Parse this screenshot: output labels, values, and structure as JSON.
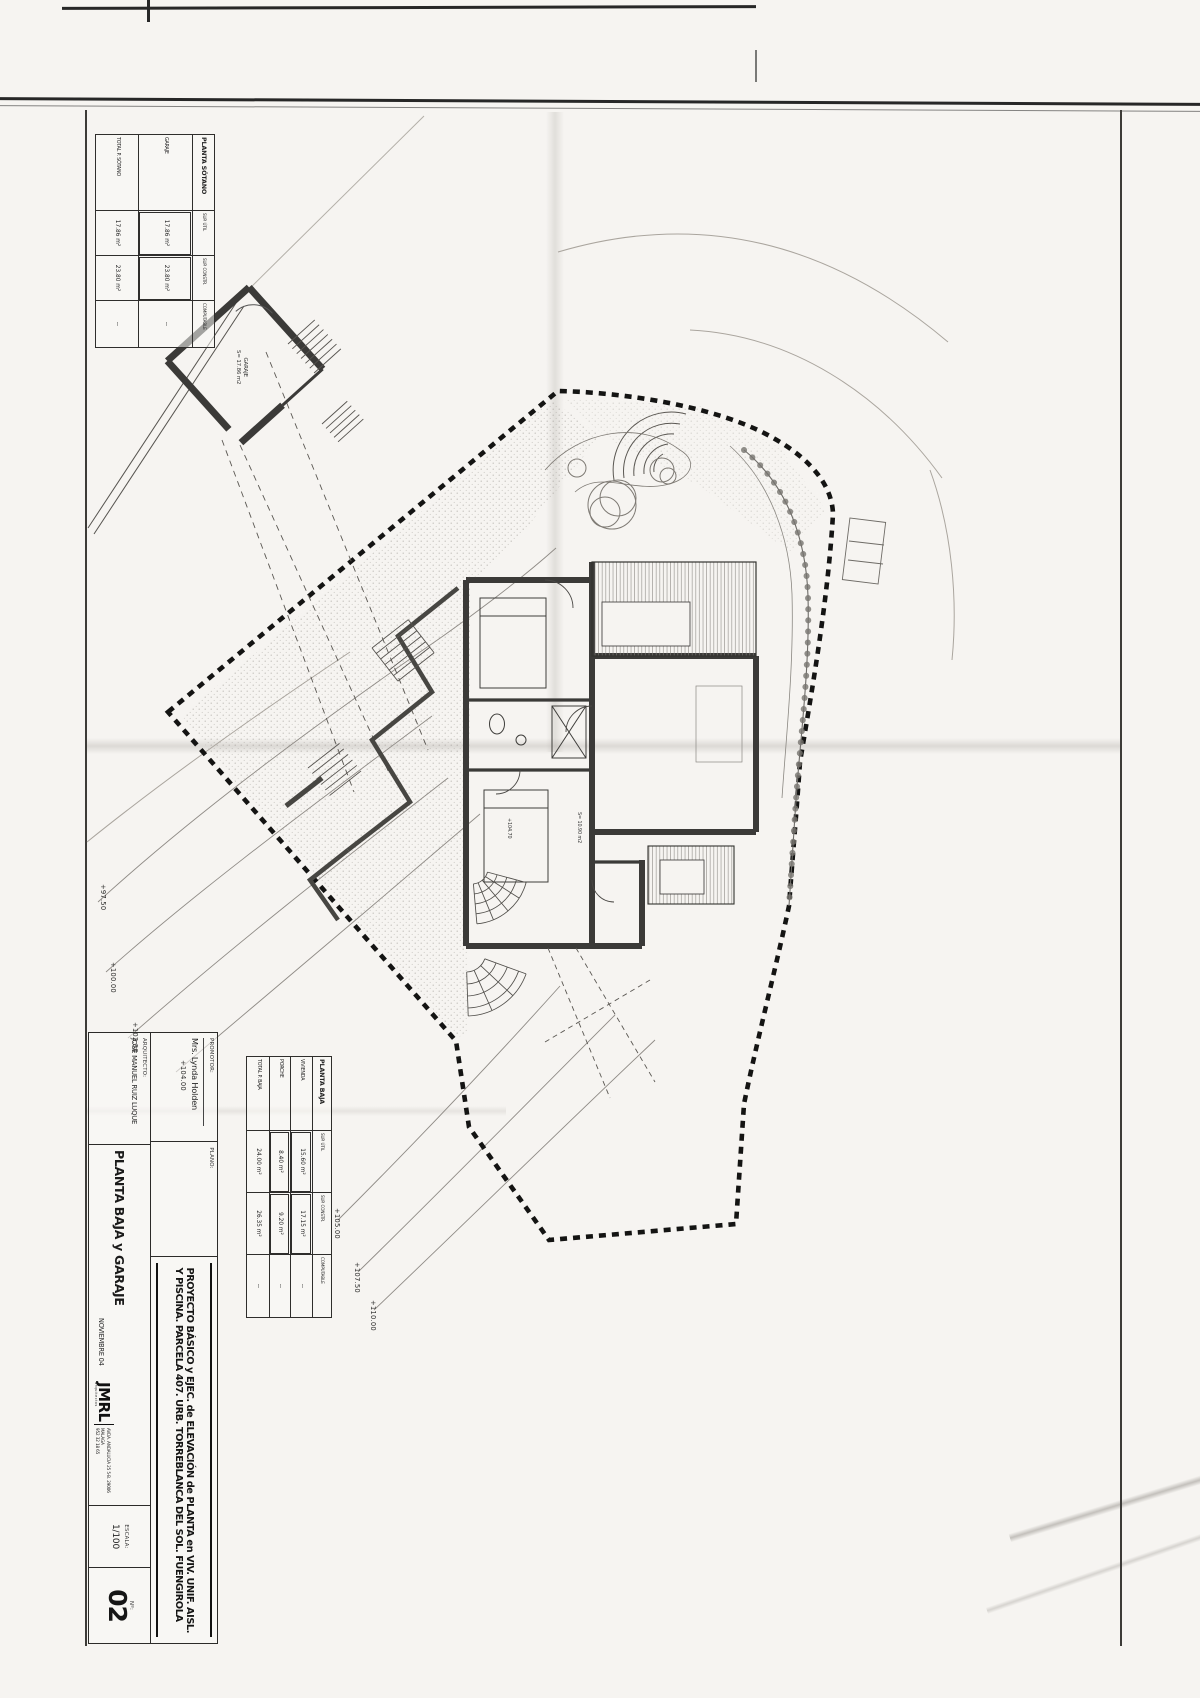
{
  "sheet": {
    "promotor_label": "PROMOTOR:",
    "promotor_name": "Mrs. Lynda Holden",
    "plano_label": "PLANO:",
    "plano_name": "PLANTA BAJA y GARAJE",
    "arquitecto_label": "ARQUITECTO:",
    "arquitecto_name": "JOSE MANUEL RUIZ LUQUE",
    "project_title_line1": "PROYECTO BÁSICO y EJEC. de ELEVACIÓN de PLANTA en VIV. UNIF. AISL.",
    "project_title_line2": "Y PISCINA. PARCELA 407. URB. TORREBLANCA DEL SOL. FUENGIROLA",
    "date": "NOVIEMBRE 04",
    "logo_text": "JMRL",
    "logo_subtext": "arquitectos",
    "logo_address": "AVDA. ANDALUCIA 25 5-B. 29006 MALAGA",
    "logo_phone": "952 32 18 65",
    "scale_label": "ESCALA:",
    "scale_value": "1/100",
    "sheet_no_label": "Nº:",
    "sheet_no_value": "02"
  },
  "area_tables": {
    "planta_sotano": {
      "title": "PLANTA SÓTANO",
      "columns": [
        "SUP. ÚTIL",
        "SUP. CONSTR.",
        "COMPUTABLE"
      ],
      "rows": [
        {
          "name": "GARAJE",
          "util": "17.86 m²",
          "constr": "23.80 m²",
          "comp": "--"
        },
        {
          "name": "TOTAL P. SÓTANO",
          "util": "17.86 m²",
          "constr": "23.80 m²",
          "comp": "--"
        }
      ]
    },
    "planta_baja": {
      "title": "PLANTA BAJA",
      "columns": [
        "SUP. ÚTIL",
        "SUP. CONSTR.",
        "COMPUTABLE"
      ],
      "rows": [
        {
          "name": "VIVIENDA",
          "util": "15.60 m²",
          "constr": "17.15 m²",
          "comp": "--"
        },
        {
          "name": "PORCHE",
          "util": "8.40 m²",
          "constr": "9.20 m²",
          "comp": "--"
        },
        {
          "name": "TOTAL P. BAJA",
          "util": "24.00 m²",
          "constr": "26.35 m²",
          "comp": "--"
        }
      ]
    }
  },
  "plan_annotations": {
    "garage_room_label": "GARAJE",
    "garage_room_area": "S= 17.86 m2",
    "house_level_label": "+104.70",
    "house_room_area": "S= 10.90 m2",
    "contour_labels": [
      {
        "text": "+97.50"
      },
      {
        "text": "+100.00"
      },
      {
        "text": "+102.50"
      },
      {
        "text": "+104.00"
      },
      {
        "text": "+105.00"
      },
      {
        "text": "+107.50"
      },
      {
        "text": "+110.00"
      }
    ]
  }
}
